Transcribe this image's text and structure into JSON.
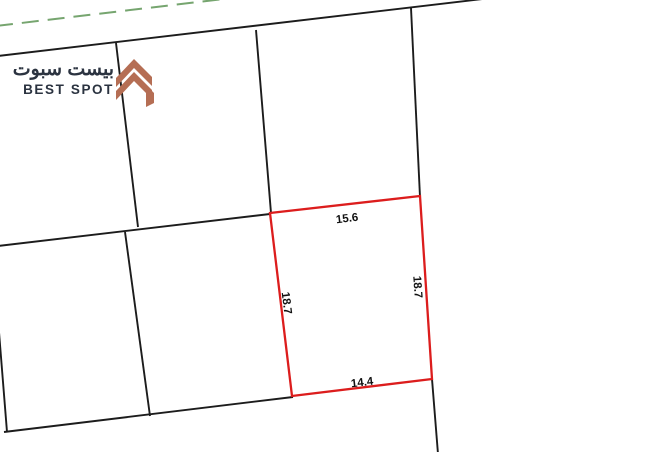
{
  "map": {
    "background_color": "#ffffff",
    "boundary_color": "#1c1c1c",
    "dashed_line_color": "#76a56f",
    "logo": {
      "arabic": "بيست سبوت",
      "english": "BEST SPOT",
      "text_color": "#2b3340",
      "icon_color": "#b56e54"
    },
    "highlighted_plot": {
      "outline_color": "#dc1d1d",
      "dimension_top": "15.6",
      "dimension_right": "18.7",
      "dimension_bottom": "14.4",
      "dimension_left": "18.7"
    }
  }
}
